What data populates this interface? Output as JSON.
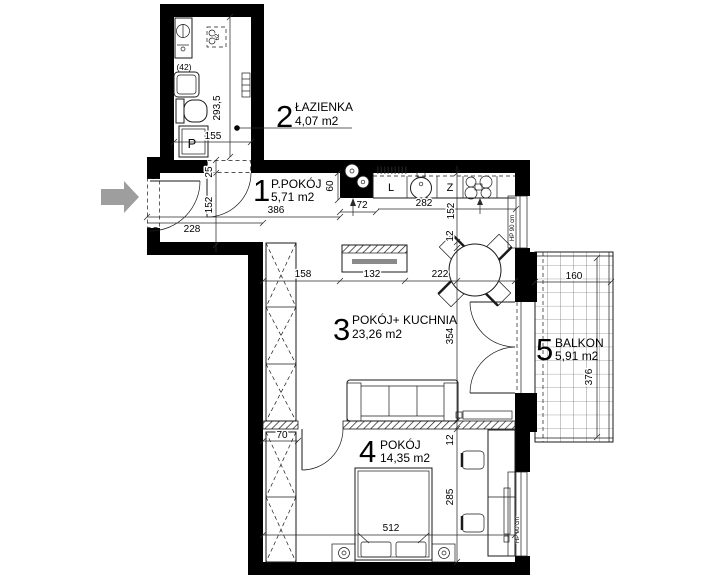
{
  "plan": {
    "rooms": {
      "r1": {
        "num": "1",
        "name": "P.POKÓJ",
        "area": "5,71 m2"
      },
      "r2": {
        "num": "2",
        "name": "ŁAZIENKA",
        "area": "4,07 m2"
      },
      "r3": {
        "num": "3",
        "name": "POKÓJ+ KUCHNIA",
        "area": "23,26 m2"
      },
      "r4": {
        "num": "4",
        "name": "POKÓJ",
        "area": "14,35 m2"
      },
      "r5": {
        "num": "5",
        "name": "BALKON",
        "area": "5,91 m2"
      }
    },
    "appliances": {
      "fridge": "L",
      "dishwasher": "Z",
      "washing_machine": "P",
      "cabinet": "(42)",
      "water_heater": "62"
    },
    "window_sill_label": "HP 90 cm",
    "dims": {
      "bath_height": "293,5",
      "bath_width": "155",
      "entry_nib": "25",
      "entry_width": "152",
      "entry_door": "228",
      "hall_length": "386",
      "kitchen_nib": "60",
      "pillar_width": "72",
      "counter_length": "282",
      "kitchen_depth": "152",
      "kitchen_step": "12",
      "living_left": "158",
      "living_mid": "132",
      "living_right": "222",
      "living_height": "354",
      "balcony_width": "160",
      "balcony_height": "376",
      "bedroom_door_offset": "70",
      "partition_thickness": "12",
      "bedroom_height": "285",
      "bedroom_width": "512"
    },
    "colors": {
      "wall": "#000000",
      "line": "#1a1a1a",
      "arrow": "#9e9e9e",
      "background": "#ffffff"
    }
  }
}
